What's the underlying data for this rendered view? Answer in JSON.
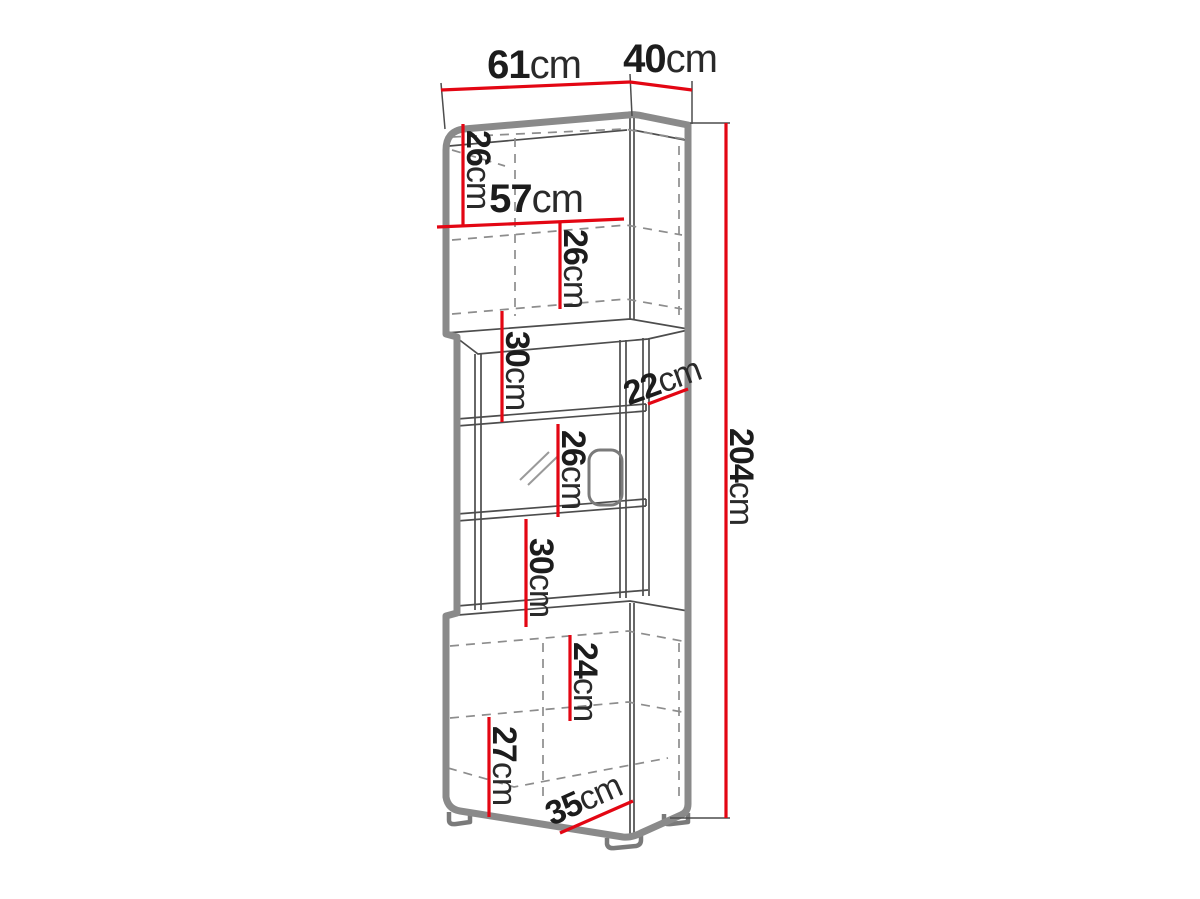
{
  "figure": {
    "kind": "furniture-dimension-diagram",
    "subject": "tall display cabinet with glass middle section",
    "unit": "cm"
  },
  "colors": {
    "dimension_red": "#e30613",
    "outline_gray": "#8a8a8a",
    "line_dark": "#4d4d4d",
    "dashed_gray": "#8d8d8d",
    "text_black": "#1c1c1c",
    "background": "#ffffff"
  },
  "dimensions": {
    "top_width": {
      "value": "61",
      "unit": "cm",
      "orientation": "horizontal",
      "meaning": "overall width"
    },
    "top_depth": {
      "value": "40",
      "unit": "cm",
      "orientation": "horizontal",
      "meaning": "overall depth"
    },
    "upper_left_height": {
      "value": "26",
      "unit": "cm",
      "orientation": "vertical",
      "meaning": "upper compartment height"
    },
    "upper_inner_width": {
      "value": "57",
      "unit": "cm",
      "orientation": "horizontal",
      "meaning": "inner width"
    },
    "upper_inner_height": {
      "value": "26",
      "unit": "cm",
      "orientation": "vertical",
      "meaning": "second upper compartment height"
    },
    "upper_open_gap": {
      "value": "30",
      "unit": "cm",
      "orientation": "vertical",
      "meaning": "upper open shelf gap"
    },
    "middle_depth": {
      "value": "22",
      "unit": "cm",
      "orientation": "diagonal",
      "meaning": "open section depth"
    },
    "total_height": {
      "value": "204",
      "unit": "cm",
      "orientation": "vertical",
      "meaning": "overall height"
    },
    "glass_shelf_gap": {
      "value": "26",
      "unit": "cm",
      "orientation": "vertical",
      "meaning": "glass shelf spacing"
    },
    "lower_open_gap": {
      "value": "30",
      "unit": "cm",
      "orientation": "vertical",
      "meaning": "lower open shelf gap"
    },
    "bottom_inner_height": {
      "value": "24",
      "unit": "cm",
      "orientation": "vertical",
      "meaning": "bottom upper compartment height"
    },
    "bottom_lower_height": {
      "value": "27",
      "unit": "cm",
      "orientation": "vertical",
      "meaning": "bottom lower compartment height"
    },
    "bottom_depth": {
      "value": "35",
      "unit": "cm",
      "orientation": "diagonal",
      "meaning": "base depth"
    }
  }
}
